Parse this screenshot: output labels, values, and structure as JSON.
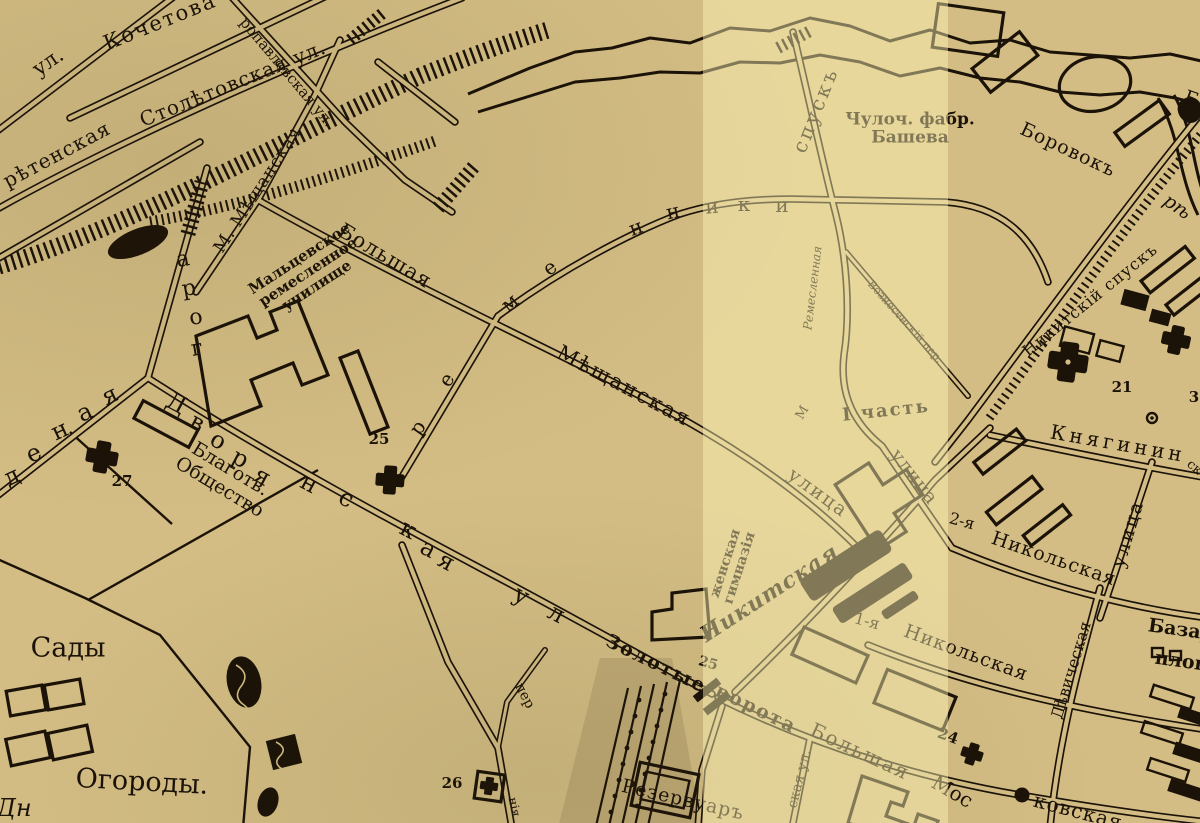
{
  "map": {
    "colors": {
      "paper": "#d3bd84",
      "paper_light_band": "rgba(255,246,185,0.45)",
      "ink": "#1b1208"
    },
    "light_band": {
      "left": 703,
      "width": 245
    },
    "labels": [
      {
        "id": "ul-top-left",
        "t": "ул.",
        "x": 48,
        "y": 62,
        "r": -35,
        "s": 21
      },
      {
        "id": "kochetova",
        "t": "Кочетова",
        "x": 160,
        "y": 22,
        "r": -22,
        "s": 21,
        "ls": 2
      },
      {
        "id": "petropavlovskaya",
        "t": "ропавловская ул.",
        "x": 287,
        "y": 72,
        "r": 50,
        "s": 15
      },
      {
        "id": "stoletovskaya",
        "t": "Столѣтовская ул.",
        "x": 233,
        "y": 84,
        "r": -22,
        "s": 20,
        "ls": 1
      },
      {
        "id": "sretenskaya",
        "t": "рѣтенская",
        "x": 57,
        "y": 155,
        "r": -28,
        "s": 20,
        "ls": 1
      },
      {
        "id": "m-meshchanskaya",
        "t": "М. Мѣщанская",
        "x": 258,
        "y": 190,
        "r": -57,
        "s": 17,
        "ls": 1
      },
      {
        "id": "maltsevskoe-uchilishche",
        "t": "Мальцевское\nремесленное\nучилище",
        "x": 308,
        "y": 272,
        "r": -33,
        "s": 15,
        "b": 1
      },
      {
        "id": "bolshaya",
        "t": "Большая",
        "x": 385,
        "y": 256,
        "r": 31,
        "s": 21,
        "ls": 1
      },
      {
        "id": "meshchanskaya",
        "t": "Мѣщанская",
        "x": 624,
        "y": 386,
        "r": 28,
        "s": 21,
        "ls": 2
      },
      {
        "id": "ulitsa-1",
        "t": "улица",
        "x": 818,
        "y": 493,
        "r": 36,
        "s": 19,
        "ls": 2
      },
      {
        "id": "ulitsa-2",
        "t": "улица",
        "x": 914,
        "y": 477,
        "r": 52,
        "s": 19,
        "ls": 1
      },
      {
        "id": "spusk",
        "t": "спускъ",
        "x": 816,
        "y": 110,
        "r": -68,
        "s": 20,
        "ls": 3
      },
      {
        "id": "chuloch-fabrika-basheva",
        "t": "Чулоч. фабр.\nБашева",
        "x": 910,
        "y": 129,
        "r": 0,
        "s": 17,
        "b": 1
      },
      {
        "id": "borovok",
        "t": "Боровокъ",
        "x": 1068,
        "y": 150,
        "r": 25,
        "s": 19,
        "ls": 1
      },
      {
        "id": "reka",
        "t": "рѣ",
        "x": 1177,
        "y": 207,
        "r": 35,
        "s": 19,
        "i": 1
      },
      {
        "id": "b-edge",
        "t": "Б",
        "x": 1191,
        "y": 99,
        "r": 20,
        "s": 19
      },
      {
        "id": "nikitsky-spusk",
        "t": "Никитскій спускъ",
        "x": 1090,
        "y": 300,
        "r": -39,
        "s": 16,
        "ls": 1
      },
      {
        "id": "chast-1",
        "t": "I часть",
        "x": 886,
        "y": 411,
        "r": -6,
        "s": 18,
        "b": 1,
        "ls": 2
      },
      {
        "id": "remeslennaya",
        "t": "Ремесленная",
        "x": 813,
        "y": 288,
        "r": -83,
        "s": 12,
        "i": 1
      },
      {
        "id": "voznesensky-per",
        "t": "Вознесенскій пер.",
        "x": 905,
        "y": 322,
        "r": 48,
        "s": 11
      },
      {
        "id": "knyaginin",
        "t": "Княгинин",
        "x": 1118,
        "y": 444,
        "r": 10,
        "s": 20,
        "ls": 4
      },
      {
        "id": "sk-cont",
        "t": "ск",
        "x": 1194,
        "y": 468,
        "r": 40,
        "s": 13
      },
      {
        "id": "ulitsa-right",
        "t": "улица",
        "x": 1128,
        "y": 534,
        "r": -73,
        "s": 19,
        "ls": 2
      },
      {
        "id": "nikolskaya2-prefix",
        "t": "2-я",
        "x": 962,
        "y": 521,
        "r": 15,
        "s": 16
      },
      {
        "id": "nikolskaya2",
        "t": "Никольская",
        "x": 1054,
        "y": 559,
        "r": 19,
        "s": 19,
        "ls": 1
      },
      {
        "id": "nikolskaya1-prefix",
        "t": "1-я",
        "x": 867,
        "y": 621,
        "r": 15,
        "s": 16
      },
      {
        "id": "nikolskaya1",
        "t": "Никольская",
        "x": 966,
        "y": 653,
        "r": 20,
        "s": 19,
        "ls": 1
      },
      {
        "id": "devicheskaya",
        "t": "Дѣвическая",
        "x": 1071,
        "y": 670,
        "r": -73,
        "s": 16
      },
      {
        "id": "bazar-line1",
        "t": "Базар",
        "x": 1181,
        "y": 630,
        "r": 8,
        "s": 19,
        "b": 1
      },
      {
        "id": "bazar-line2",
        "t": "площ",
        "x": 1185,
        "y": 662,
        "r": 8,
        "s": 19,
        "b": 1
      },
      {
        "id": "zolotye",
        "t": "Золотые",
        "x": 656,
        "y": 664,
        "r": 26,
        "s": 19,
        "ls": 2,
        "b": 1
      },
      {
        "id": "vorota",
        "t": "ворота",
        "x": 756,
        "y": 709,
        "r": 26,
        "s": 19,
        "ls": 2,
        "b": 1
      },
      {
        "id": "bolshaya-mos-1",
        "t": "Большая",
        "x": 860,
        "y": 752,
        "r": 25,
        "s": 20,
        "ls": 2
      },
      {
        "id": "bolshaya-mos-2",
        "t": "Мос",
        "x": 952,
        "y": 792,
        "r": 30,
        "s": 20
      },
      {
        "id": "kovskaya",
        "t": "ковская",
        "x": 1078,
        "y": 812,
        "r": 15,
        "s": 20,
        "ls": 1
      },
      {
        "id": "skaya-ul",
        "t": "ская ул.",
        "x": 800,
        "y": 779,
        "r": -76,
        "s": 14
      },
      {
        "id": "rezervuar",
        "t": "Резервуаръ",
        "x": 683,
        "y": 800,
        "r": 13,
        "s": 19,
        "ls": 1
      },
      {
        "id": "zhenskaya-gimnaziya",
        "t": "женская\nгимназія",
        "x": 733,
        "y": 566,
        "r": -72,
        "s": 14,
        "b": 1
      },
      {
        "id": "nikitskaya",
        "t": "Никитская",
        "x": 770,
        "y": 594,
        "r": -33,
        "s": 22,
        "b": 1,
        "i": 1,
        "ls": 1
      },
      {
        "id": "sady",
        "t": "Сады",
        "x": 68,
        "y": 648,
        "r": 0,
        "s": 27
      },
      {
        "id": "ogorody",
        "t": "Огороды.",
        "x": 142,
        "y": 782,
        "r": 3,
        "s": 27
      },
      {
        "id": "dn-edge",
        "t": "Дн",
        "x": 14,
        "y": 809,
        "r": 0,
        "s": 24,
        "i": 1
      },
      {
        "id": "per-lane",
        "t": "пер",
        "x": 524,
        "y": 696,
        "r": 62,
        "s": 14
      },
      {
        "id": "niya-edge",
        "t": "нія",
        "x": 514,
        "y": 807,
        "r": 78,
        "s": 12
      },
      {
        "id": "num-21",
        "t": "21",
        "x": 1122,
        "y": 387,
        "r": 0,
        "s": 15,
        "b": 1
      },
      {
        "id": "num-24",
        "t": "24",
        "x": 948,
        "y": 736,
        "r": 20,
        "s": 15,
        "b": 1
      },
      {
        "id": "num-25-dvoryanskaya",
        "t": "25",
        "x": 379,
        "y": 439,
        "r": 0,
        "s": 15,
        "b": 1
      },
      {
        "id": "num-25-gate",
        "t": "25",
        "x": 708,
        "y": 664,
        "r": 15,
        "s": 14,
        "b": 1
      },
      {
        "id": "num-26",
        "t": "26",
        "x": 452,
        "y": 783,
        "r": 0,
        "s": 15,
        "b": 1
      },
      {
        "id": "num-27",
        "t": "27",
        "x": 122,
        "y": 481,
        "r": 0,
        "s": 15,
        "b": 1
      },
      {
        "id": "num-3",
        "t": "3",
        "x": 1194,
        "y": 397,
        "r": 0,
        "s": 15,
        "b": 1
      },
      {
        "id": "studenaya-d",
        "t": "д",
        "x": 12,
        "y": 477,
        "r": -25,
        "s": 24
      },
      {
        "id": "studenaya-e",
        "t": "е",
        "x": 34,
        "y": 454,
        "r": -25,
        "s": 24
      },
      {
        "id": "studenaya-n",
        "t": "н",
        "x": 60,
        "y": 431,
        "r": -25,
        "s": 24
      },
      {
        "id": "studenaya-a",
        "t": "а",
        "x": 85,
        "y": 413,
        "r": -25,
        "s": 24
      },
      {
        "id": "studenaya-ya",
        "t": "я",
        "x": 110,
        "y": 396,
        "r": -25,
        "s": 24
      },
      {
        "id": "gora-g",
        "t": "г",
        "x": 197,
        "y": 349,
        "r": -10,
        "s": 22
      },
      {
        "id": "gora-o",
        "t": "о",
        "x": 196,
        "y": 318,
        "r": -10,
        "s": 22
      },
      {
        "id": "gora-r",
        "t": "р",
        "x": 189,
        "y": 289,
        "r": -10,
        "s": 22
      },
      {
        "id": "gora-a",
        "t": "а",
        "x": 183,
        "y": 260,
        "r": -10,
        "s": 22
      },
      {
        "id": "dvor-1",
        "t": "Д",
        "x": 176,
        "y": 404,
        "r": 28,
        "s": 24
      },
      {
        "id": "dvor-2",
        "t": "в",
        "x": 197,
        "y": 423,
        "r": 28,
        "s": 24
      },
      {
        "id": "dvor-3",
        "t": "о",
        "x": 218,
        "y": 441,
        "r": 28,
        "s": 24
      },
      {
        "id": "dvor-4",
        "t": "р",
        "x": 240,
        "y": 459,
        "r": 28,
        "s": 24
      },
      {
        "id": "dvor-5",
        "t": "я",
        "x": 262,
        "y": 477,
        "r": 28,
        "s": 24
      },
      {
        "id": "dvor-6",
        "t": "н",
        "x": 309,
        "y": 484,
        "r": 28,
        "s": 24
      },
      {
        "id": "dvor-7",
        "t": "с",
        "x": 346,
        "y": 499,
        "r": 28,
        "s": 24
      },
      {
        "id": "dvor-8",
        "t": "к",
        "x": 408,
        "y": 530,
        "r": 28,
        "s": 24
      },
      {
        "id": "dvor-9",
        "t": "а",
        "x": 428,
        "y": 549,
        "r": 28,
        "s": 24
      },
      {
        "id": "dvor-10",
        "t": "я",
        "x": 446,
        "y": 562,
        "r": 28,
        "s": 24
      },
      {
        "id": "dvor-11",
        "t": "у",
        "x": 521,
        "y": 596,
        "r": 28,
        "s": 24
      },
      {
        "id": "dvor-12",
        "t": "л",
        "x": 556,
        "y": 614,
        "r": 28,
        "s": 24
      },
      {
        "id": "remenniki-1",
        "t": "р",
        "x": 418,
        "y": 428,
        "r": -55,
        "s": 20
      },
      {
        "id": "remenniki-2",
        "t": "е",
        "x": 447,
        "y": 380,
        "r": -55,
        "s": 20
      },
      {
        "id": "remenniki-3",
        "t": "м",
        "x": 510,
        "y": 303,
        "r": -40,
        "s": 20
      },
      {
        "id": "remenniki-4",
        "t": "е",
        "x": 550,
        "y": 268,
        "r": -35,
        "s": 20
      },
      {
        "id": "remenniki-5",
        "t": "н",
        "x": 636,
        "y": 228,
        "r": -20,
        "s": 20
      },
      {
        "id": "remenniki-6",
        "t": "н",
        "x": 673,
        "y": 212,
        "r": -12,
        "s": 20
      },
      {
        "id": "remenniki-7",
        "t": "и",
        "x": 712,
        "y": 207,
        "r": -5,
        "s": 20
      },
      {
        "id": "remenniki-8",
        "t": "к",
        "x": 744,
        "y": 205,
        "r": 0,
        "s": 20
      },
      {
        "id": "remenniki-9",
        "t": "и",
        "x": 782,
        "y": 206,
        "r": 0,
        "s": 20
      },
      {
        "id": "m-stray",
        "t": "М",
        "x": 803,
        "y": 413,
        "r": -60,
        "s": 13
      },
      {
        "id": "blagotv-obshchestvo",
        "t": "Благотв.\nОбщество",
        "x": 225,
        "y": 478,
        "r": 31,
        "s": 19
      }
    ]
  }
}
